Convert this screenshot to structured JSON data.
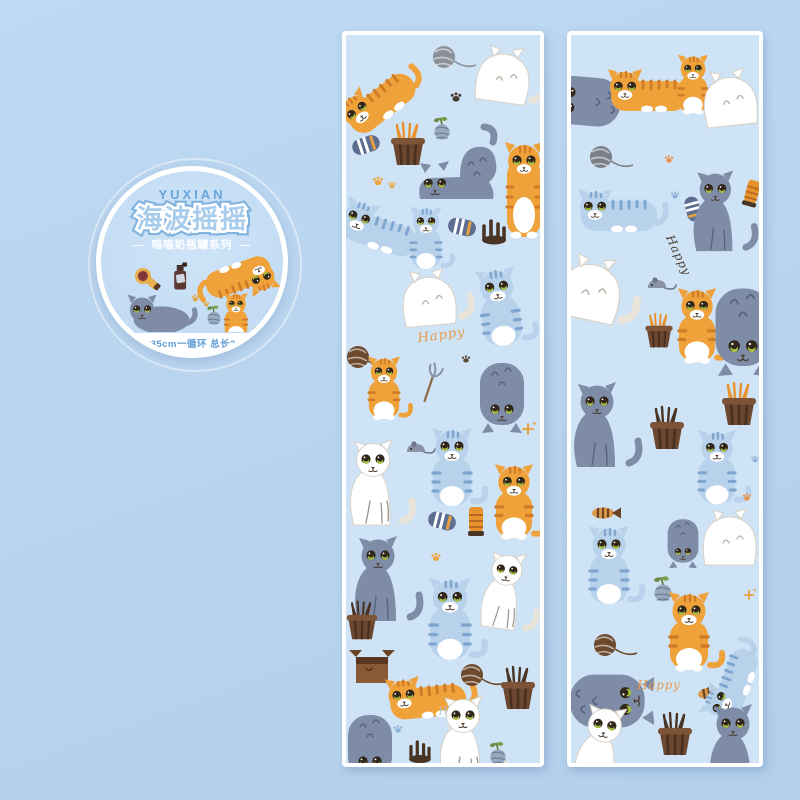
{
  "badge": {
    "brand": "YUXIAN",
    "title": "海波摇摇",
    "subtitle": "喵喵奶瓶罐系列",
    "dash": "—",
    "spec": "5x35cm一循环 总长2m"
  },
  "labels": {
    "happy": "Happy"
  },
  "colors": {
    "page_bg": "#b7d3ee",
    "strip_bg": "#cfe3f6",
    "strip_border": "#ffffff",
    "badge_ring": "#ffffff",
    "badge_bg": "#c3dcf4",
    "brand_blue": "#69a6da",
    "title_fill": "#a8cdec",
    "title_outline": "#7fb2de",
    "spec_blue": "#5d9bd3",
    "cat_orange": "#f0a23a",
    "cat_orange_stripe": "#cf7b27",
    "cat_gray": "#7e8ca7",
    "cat_white": "#ffffff",
    "cat_blue": "#b9d2ec",
    "cat_blue_stripe": "#7fa6cf",
    "eye_green": "#a9bf3f",
    "basket_brown": "#6b4730",
    "grass_orange": "#e8922e"
  },
  "badge_art": {
    "items": [
      {
        "m": "brush",
        "x": -58,
        "y": -20,
        "r": -20
      },
      {
        "m": "spray",
        "x": -14,
        "y": -20
      },
      {
        "m": "cat-orange-lying",
        "x": 56,
        "y": -16,
        "r": 160,
        "s": 1.05
      },
      {
        "m": "cat-orange-sit",
        "x": 52,
        "y": 30,
        "s": 0.7
      },
      {
        "m": "cat-gray-lying",
        "x": -38,
        "y": 28
      },
      {
        "m": "paw",
        "x": 4,
        "y": 6,
        "c": "#e8a23f",
        "s": 0.6
      },
      {
        "m": "paw",
        "x": 17,
        "y": 13,
        "c": "#e8a23f",
        "s": 0.45
      },
      {
        "m": "sprout",
        "x": 26,
        "y": 30,
        "s": 0.9
      }
    ]
  },
  "strips": {
    "left": {
      "items": [
        {
          "m": "cat-orange-lying",
          "x": 34,
          "y": 66,
          "r": -38
        },
        {
          "m": "yarn",
          "x": 98,
          "y": 22,
          "c": "#8a8f98"
        },
        {
          "m": "cat-white-back",
          "x": 163,
          "y": 40,
          "r": 8
        },
        {
          "m": "paw",
          "x": 110,
          "y": 62,
          "c": "#4a3b2d",
          "s": 0.7
        },
        {
          "m": "sprout",
          "x": 96,
          "y": 97,
          "s": 0.9
        },
        {
          "m": "sock",
          "x": 20,
          "y": 110,
          "r": -18
        },
        {
          "m": "basket-grass",
          "x": 62,
          "y": 112
        },
        {
          "m": "cat-gray-stretch",
          "x": 120,
          "y": 132
        },
        {
          "m": "cat-orange-stand",
          "x": 178,
          "y": 158
        },
        {
          "m": "paw",
          "x": 32,
          "y": 146,
          "c": "#f0a63f",
          "s": 0.65
        },
        {
          "m": "paw",
          "x": 46,
          "y": 150,
          "c": "#f0a63f",
          "s": 0.5
        },
        {
          "m": "cat-blue-lying",
          "x": 34,
          "y": 196,
          "r": 18
        },
        {
          "m": "cat-blue-sit",
          "x": 80,
          "y": 206,
          "s": 0.8
        },
        {
          "m": "sock",
          "x": 116,
          "y": 192,
          "r": 12
        },
        {
          "m": "crown",
          "x": 148,
          "y": 196
        },
        {
          "m": "cat-white-back",
          "x": 88,
          "y": 262,
          "r": -5
        },
        {
          "m": "cat-blue-sit",
          "x": 154,
          "y": 276,
          "r": -8
        },
        {
          "m": "happy",
          "x": 96,
          "y": 304,
          "r": -8,
          "c": "#e59b4a"
        },
        {
          "m": "yarn",
          "x": 12,
          "y": 322,
          "c": "#6d4a2e"
        },
        {
          "m": "cat-orange-sit",
          "x": 38,
          "y": 356,
          "s": 0.8
        },
        {
          "m": "wand",
          "x": 82,
          "y": 352,
          "r": -20
        },
        {
          "m": "cat-gray-hang",
          "x": 156,
          "y": 362
        },
        {
          "m": "paw",
          "x": 120,
          "y": 324,
          "c": "#5a4a3a",
          "s": 0.55
        },
        {
          "m": "sparkle",
          "x": 182,
          "y": 394,
          "c": "#e8a23f",
          "s": 0.8
        },
        {
          "m": "mouse",
          "x": 70,
          "y": 414
        },
        {
          "m": "cat-white-sit",
          "x": 32,
          "y": 452
        },
        {
          "m": "cat-blue-sit",
          "x": 106,
          "y": 436
        },
        {
          "m": "cat-orange-sit",
          "x": 168,
          "y": 470,
          "s": 0.95
        },
        {
          "m": "sock",
          "x": 96,
          "y": 486,
          "r": 14
        },
        {
          "m": "tube",
          "x": 130,
          "y": 486
        },
        {
          "m": "paw",
          "x": 90,
          "y": 522,
          "c": "#f0a63f",
          "s": 0.6
        },
        {
          "m": "cat-gray-sit",
          "x": 38,
          "y": 548
        },
        {
          "m": "basket-dark",
          "x": 16,
          "y": 588,
          "s": 0.9
        },
        {
          "m": "cat-blue-sit",
          "x": 104,
          "y": 588,
          "s": 1.05
        },
        {
          "m": "cat-white-sit",
          "x": 162,
          "y": 560,
          "r": 8,
          "s": 0.9
        },
        {
          "m": "box",
          "x": 26,
          "y": 634
        },
        {
          "m": "cat-orange-lying",
          "x": 82,
          "y": 664,
          "r": -6
        },
        {
          "m": "yarn",
          "x": 126,
          "y": 640,
          "c": "#6d4a2e"
        },
        {
          "m": "basket-dark",
          "x": 172,
          "y": 656
        },
        {
          "m": "happy",
          "x": 112,
          "y": 678,
          "r": -6,
          "c": "#aac6e4",
          "s": 0.8
        },
        {
          "m": "cat-white-sit",
          "x": 122,
          "y": 708
        },
        {
          "m": "cat-gray-hang",
          "x": 24,
          "y": 714
        },
        {
          "m": "crown",
          "x": 74,
          "y": 716,
          "s": 0.9
        },
        {
          "m": "sprout",
          "x": 152,
          "y": 722,
          "s": 0.9
        },
        {
          "m": "paw",
          "x": 52,
          "y": 694,
          "c": "#8fb2d8",
          "s": 0.55
        }
      ]
    },
    "right": {
      "items": [
        {
          "m": "cat-gray-hang",
          "x": 12,
          "y": 66,
          "r": 95,
          "s": 1.1
        },
        {
          "m": "cat-orange-lying",
          "x": 78,
          "y": 58
        },
        {
          "m": "cat-orange-sit",
          "x": 122,
          "y": 52,
          "s": 0.75
        },
        {
          "m": "cat-white-back",
          "x": 164,
          "y": 62,
          "r": -6
        },
        {
          "m": "yarn",
          "x": 30,
          "y": 122,
          "c": "#7a7f88"
        },
        {
          "m": "paw",
          "x": 98,
          "y": 124,
          "c": "#e8924a",
          "s": 0.55
        },
        {
          "m": "cat-blue-lying",
          "x": 48,
          "y": 178
        },
        {
          "m": "paw",
          "x": 104,
          "y": 160,
          "c": "#8fb2d8",
          "s": 0.55
        },
        {
          "m": "sock",
          "x": 122,
          "y": 174,
          "r": 75,
          "s": 0.9
        },
        {
          "m": "cat-gray-sit",
          "x": 150,
          "y": 180,
          "s": 0.95
        },
        {
          "m": "tube",
          "x": 181,
          "y": 158,
          "r": 15,
          "s": 0.9
        },
        {
          "m": "happy",
          "x": 104,
          "y": 222,
          "r": 65,
          "c": "#4a3b2d",
          "s": 0.9
        },
        {
          "m": "cat-white-back",
          "x": 26,
          "y": 254,
          "r": 12,
          "s": 1.15
        },
        {
          "m": "mouse",
          "x": 86,
          "y": 250
        },
        {
          "m": "basket-grass",
          "x": 88,
          "y": 298,
          "s": 0.8
        },
        {
          "m": "cat-orange-sit",
          "x": 126,
          "y": 294,
          "s": 0.95
        },
        {
          "m": "cat-gray-hang",
          "x": 172,
          "y": 296,
          "s": 1.25
        },
        {
          "m": "cat-gray-sit",
          "x": 32,
          "y": 394
        },
        {
          "m": "basket-dark",
          "x": 96,
          "y": 396
        },
        {
          "m": "basket-grass",
          "x": 168,
          "y": 372
        },
        {
          "m": "paw",
          "x": 184,
          "y": 424,
          "c": "#8fb2d8",
          "s": 0.5
        },
        {
          "m": "cat-blue-sit",
          "x": 146,
          "y": 436,
          "s": 0.95
        },
        {
          "m": "fish",
          "x": 32,
          "y": 478
        },
        {
          "m": "paw",
          "x": 176,
          "y": 462,
          "c": "#e8924a",
          "s": 0.55
        },
        {
          "m": "cat-blue-sit",
          "x": 38,
          "y": 534
        },
        {
          "m": "cat-gray-hang",
          "x": 112,
          "y": 508,
          "s": 0.7
        },
        {
          "m": "cat-white-back",
          "x": 164,
          "y": 502
        },
        {
          "m": "sparkle",
          "x": 178,
          "y": 560,
          "c": "#e8a23f",
          "s": 0.7
        },
        {
          "m": "sprout",
          "x": 92,
          "y": 558
        },
        {
          "m": "cat-orange-sit",
          "x": 118,
          "y": 600
        },
        {
          "m": "yarn",
          "x": 34,
          "y": 610,
          "c": "#6d4a2e"
        },
        {
          "m": "cat-gray-hang",
          "x": 40,
          "y": 666,
          "r": -90,
          "s": 1.2
        },
        {
          "m": "happy",
          "x": 88,
          "y": 654,
          "c": "#e59b4a",
          "s": 0.9
        },
        {
          "m": "fish",
          "x": 138,
          "y": 658,
          "r": -10
        },
        {
          "m": "cat-blue-lying",
          "x": 162,
          "y": 648,
          "r": -70,
          "s": 0.95
        },
        {
          "m": "cat-white-sit",
          "x": 34,
          "y": 718,
          "r": 10
        },
        {
          "m": "basket-dark",
          "x": 104,
          "y": 702
        },
        {
          "m": "cat-gray-sit",
          "x": 168,
          "y": 716
        }
      ]
    }
  }
}
